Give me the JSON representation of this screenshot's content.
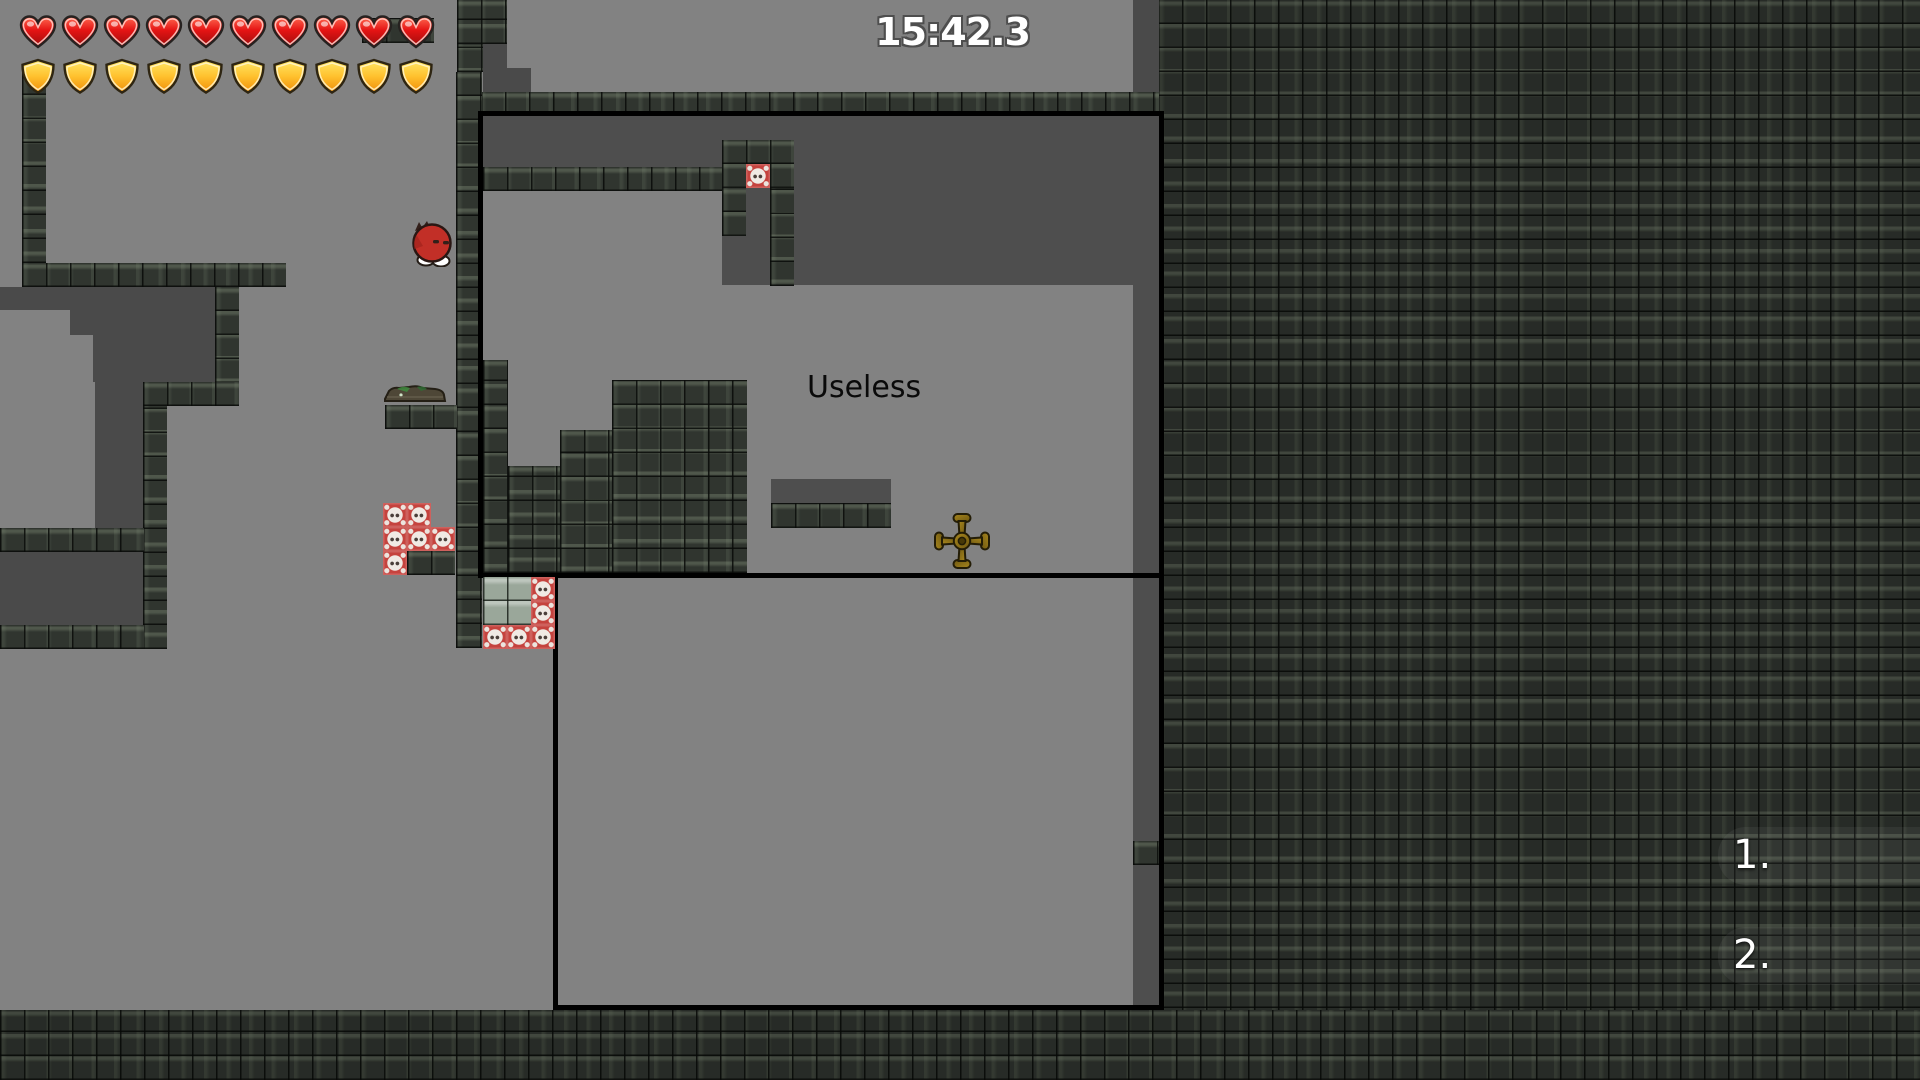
{
  "hud": {
    "timer": "15:42.3",
    "hearts_count": 10,
    "shields_count": 10
  },
  "world": {
    "room_label": "Useless",
    "markers": [
      {
        "label": "1."
      },
      {
        "label": "2."
      }
    ]
  },
  "icons": {
    "health": "heart-icon",
    "armor": "shield-icon",
    "hazard": "skull-crossbones-tile",
    "player": "red-blob-character",
    "creature": "crocodile-sprite",
    "weapon": "cross-shuriken"
  },
  "colors": {
    "floor_gray": "#828282",
    "cave_gray": "#4a4a4a",
    "tile_dark": "#30352f",
    "tile_field_dark": "#272c27",
    "hazard_red": "#c5433e",
    "heart_red": "#e51414",
    "shield_gold": "#ffc12e",
    "shuriken_gold": "#8a6d14",
    "player_red": "#c22f27",
    "room_border": "#000000",
    "timer_text": "#ffffff",
    "label_text": "#0a0a0a"
  }
}
